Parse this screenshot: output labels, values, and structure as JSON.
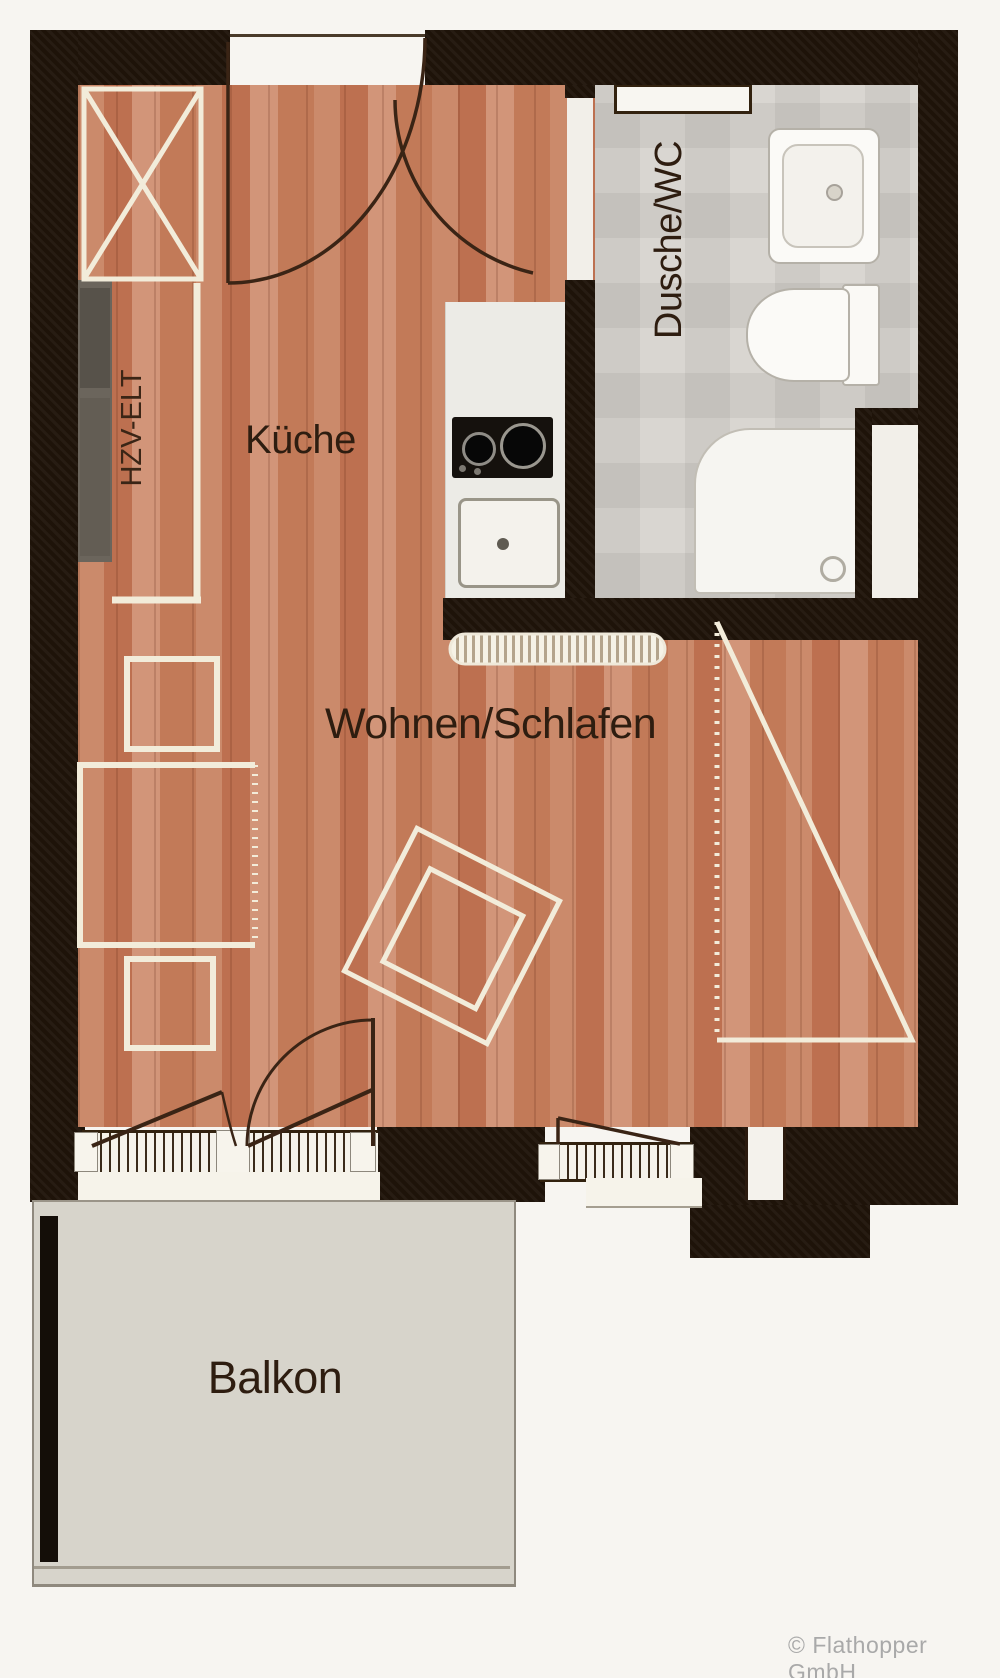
{
  "document": {
    "type": "apartment-floor-plan",
    "watermark": "© Flathopper GmbH"
  },
  "labels": {
    "kueche": "Küche",
    "dusche_wc": "Dusche/WC",
    "wohnen_schlafen": "Wohnen/Schlafen",
    "balkon": "Balkon",
    "hzv_elt": "HZV-ELT",
    "watermark": "© Flathopper GmbH"
  },
  "rooms": [
    {
      "id": "kueche",
      "label": "Küche"
    },
    {
      "id": "dusche_wc",
      "label": "Dusche/WC"
    },
    {
      "id": "wohnen_schlafen",
      "label": "Wohnen/Schlafen"
    },
    {
      "id": "balkon",
      "label": "Balkon"
    }
  ],
  "annotations": [
    {
      "id": "hzv_elt",
      "label": "HZV-ELT",
      "meaning": "heating/electrical shaft",
      "orientation": "vertical"
    }
  ],
  "fixtures": [
    "shaft-x-box",
    "utility-cabinet",
    "kitchen-counter",
    "cooktop",
    "kitchen-sink",
    "bath-radiator",
    "washbasin",
    "toilet",
    "shower-tray",
    "living-radiator",
    "entry-door",
    "bathroom-door",
    "balcony-double-door",
    "window",
    "wardrobe-triangle",
    "table-rotated",
    "cupboard-squares",
    "balcony-rail"
  ],
  "colors": {
    "wall": "#1e1309",
    "wood_floor": "#c67f60",
    "tile_floor": "#d9d6d1",
    "balcony_floor": "#d7d4cb",
    "furniture_outline": "#f2ecda",
    "door_line": "#3a2415",
    "label_text": "#2e1d10",
    "watermark_text": "#a9a9a9",
    "background": "#f7f5f1"
  }
}
